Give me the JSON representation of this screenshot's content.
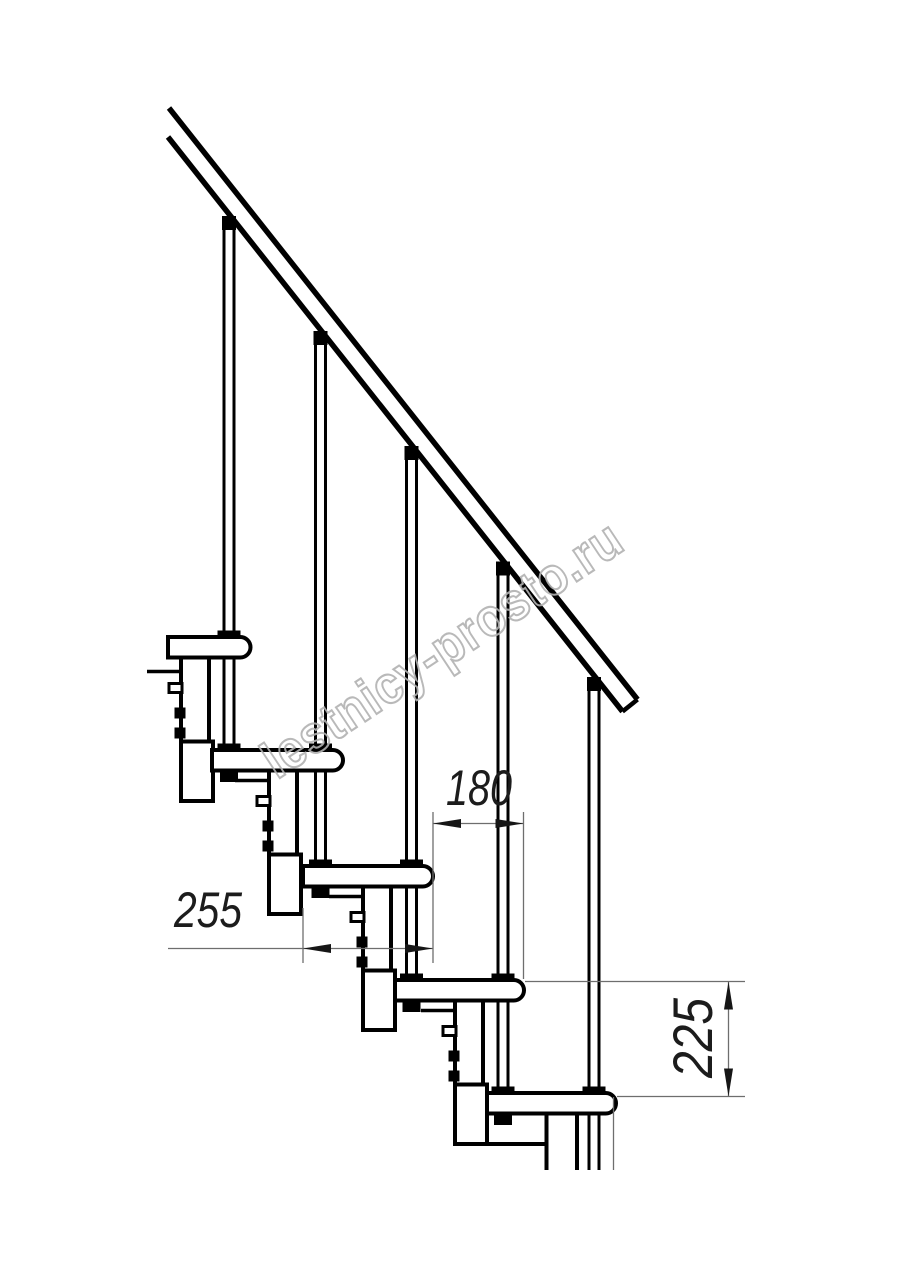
{
  "drawing": {
    "type": "Modular staircase side elevation technical drawing",
    "background": "#ffffff",
    "line_color": "#000000",
    "dim_line_color": "#6e6e6e",
    "dim_text_color": "#1c1c1c",
    "steps_visible": 5,
    "baluster_rods_visible": 5,
    "handrail_visible": true
  },
  "dimensions": {
    "step_run": {
      "value": "180",
      "orientation": "horizontal"
    },
    "tread_depth": {
      "value": "255",
      "orientation": "horizontal"
    },
    "step_rise": {
      "value": "225",
      "orientation": "vertical"
    }
  },
  "watermark": {
    "text": "lestnicy-prosto.ru",
    "color": "#b2b2b2"
  }
}
